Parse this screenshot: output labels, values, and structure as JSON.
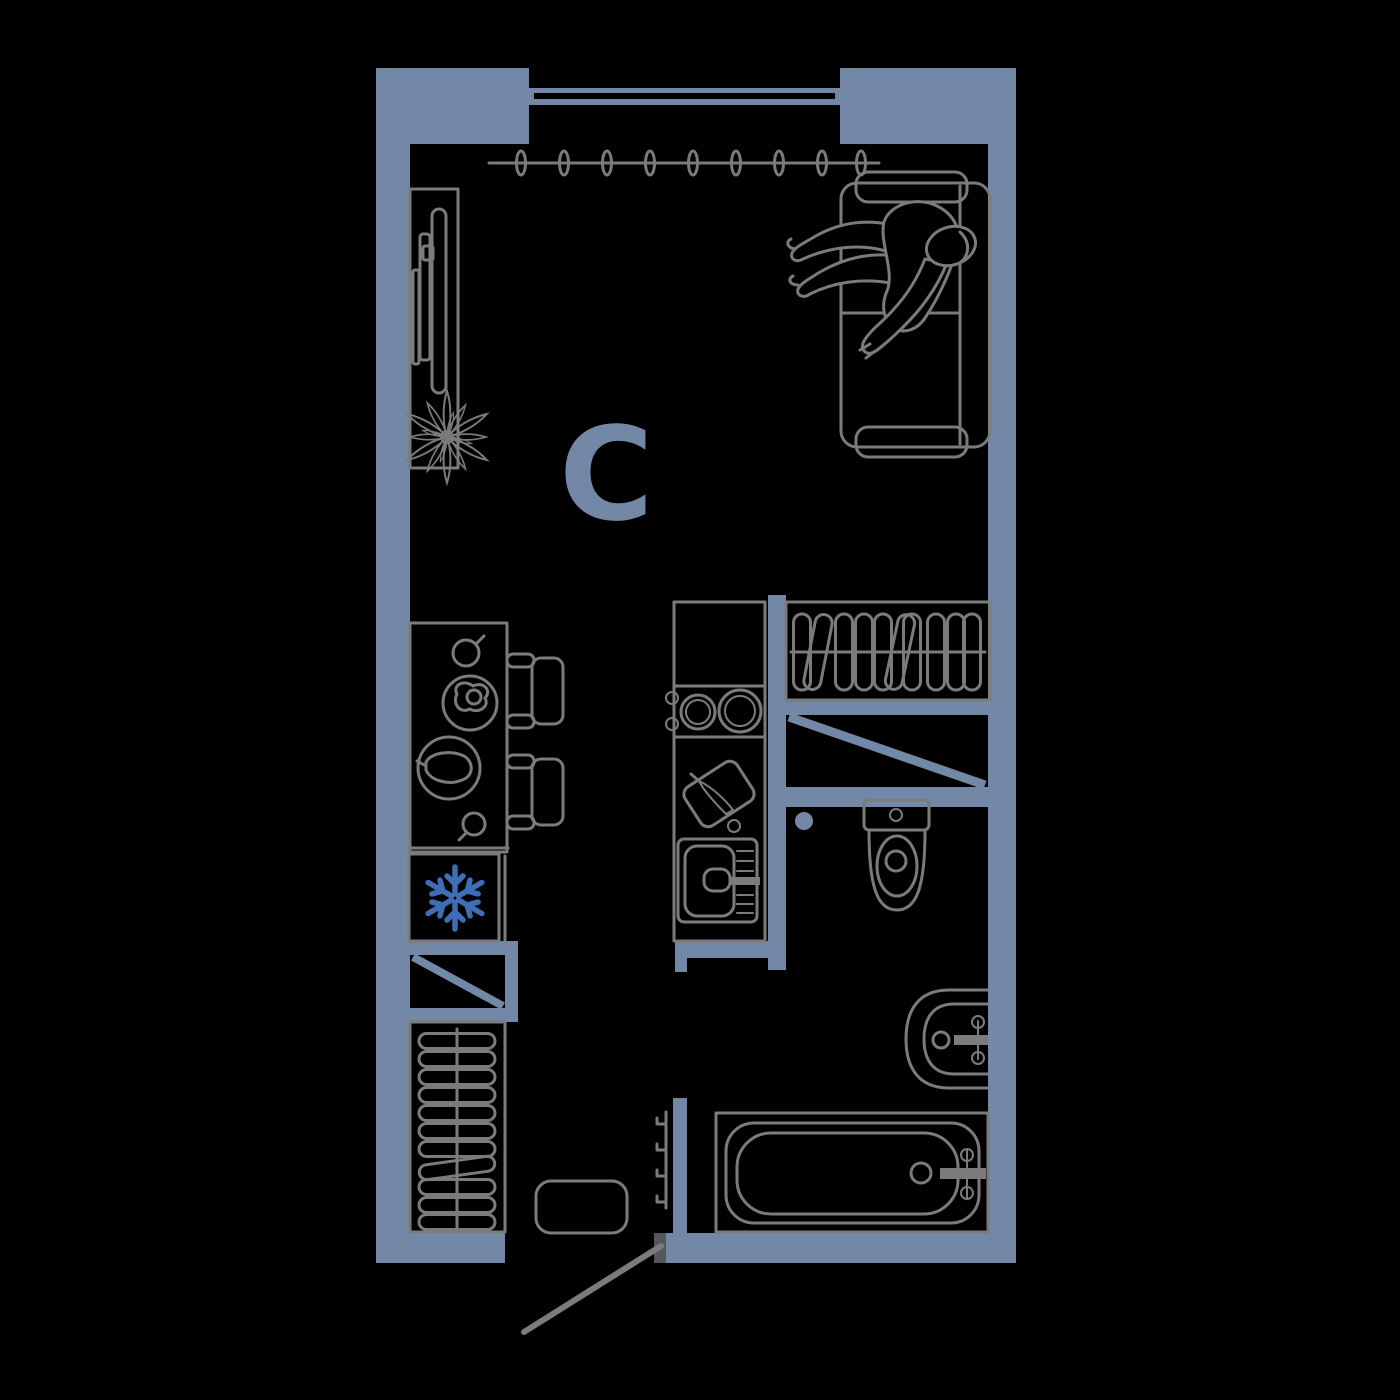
{
  "plan": {
    "room_label": "C"
  },
  "colors": {
    "background": "#000000",
    "wall": "#7388a6",
    "furniture": "#7b7b7b",
    "accent": "#3e6eb5",
    "door_frame": "#55575c"
  },
  "icons": [
    "window",
    "curtain-rail",
    "tv-console",
    "plant",
    "sofa",
    "person-lying",
    "dining-table",
    "chair",
    "plate-egg",
    "plate-food",
    "cup",
    "fridge",
    "snowflake-icon",
    "stove-burners",
    "cutting-board-knife",
    "kitchen-sink",
    "wardrobe-hangers",
    "closet-hangers",
    "vent-shaft-diagonal",
    "toilet",
    "floor-drain",
    "wash-basin",
    "bathtub",
    "wall-hooks",
    "entry-stool",
    "entry-door-leaf"
  ]
}
